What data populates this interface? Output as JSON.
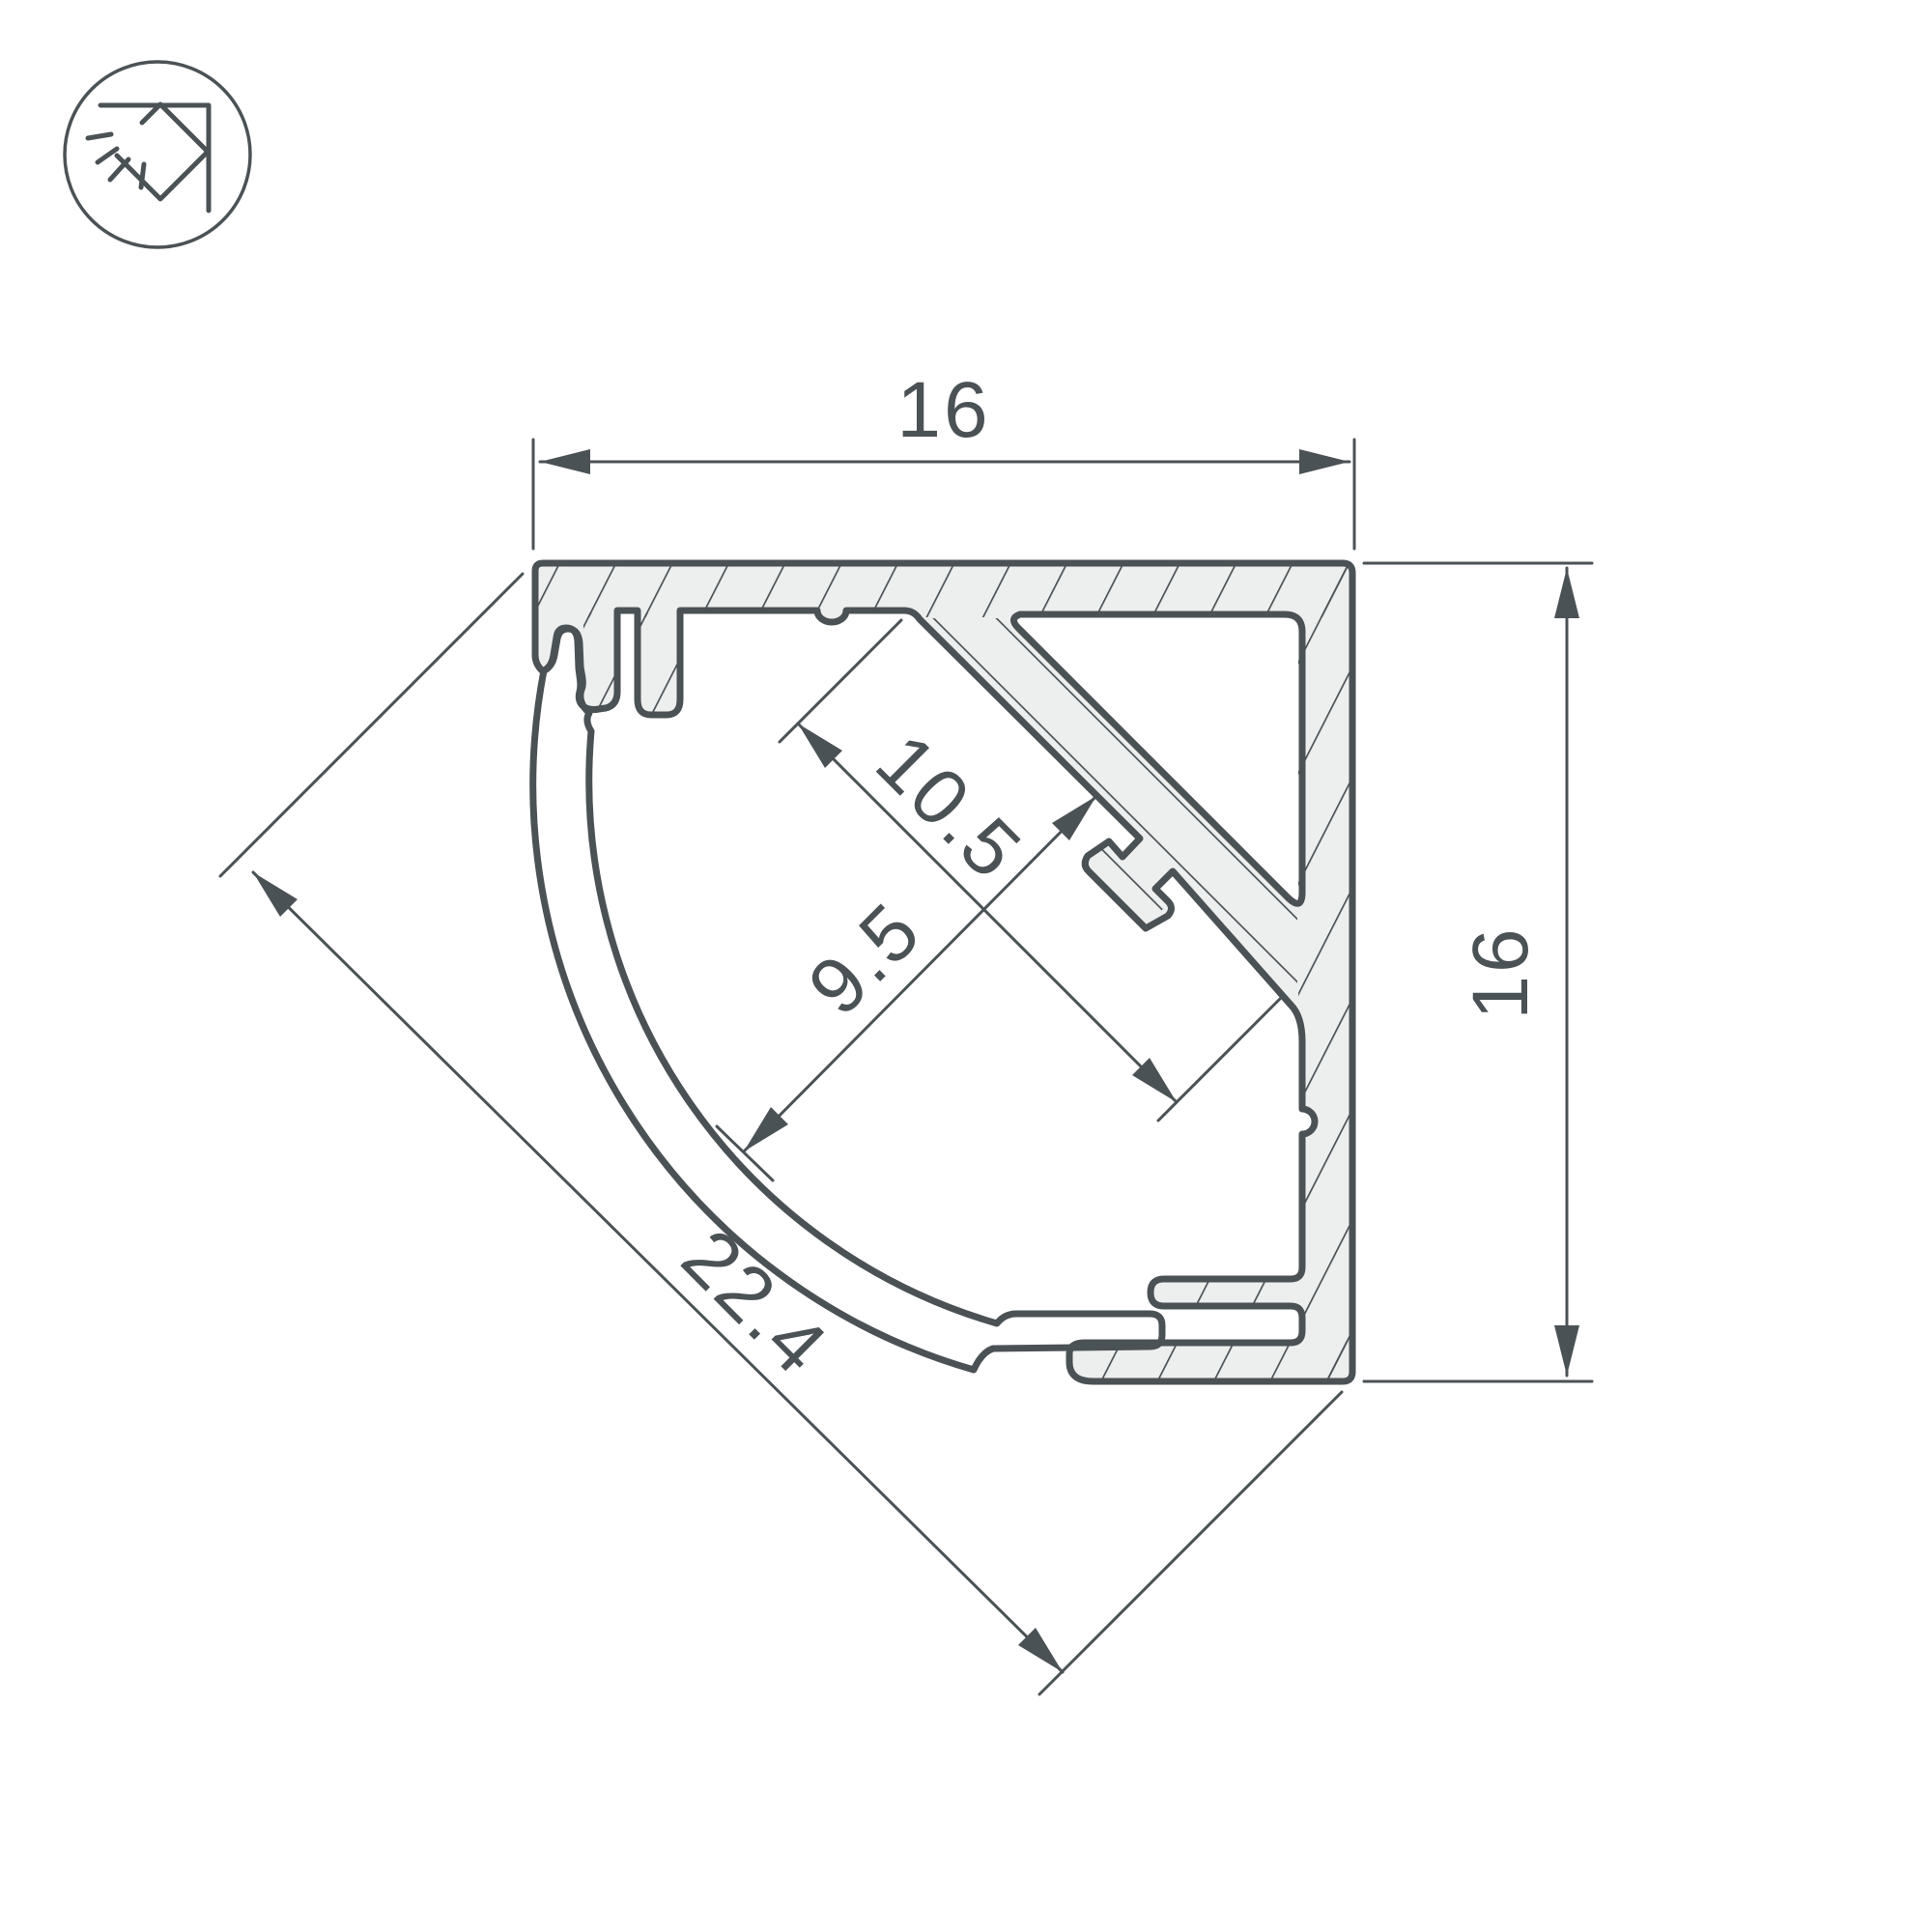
{
  "drawing": {
    "type": "technical-cross-section",
    "subject": "corner LED aluminum profile with round diffuser cover",
    "units_shown": "mm",
    "dimensions": {
      "top_width": "16",
      "right_height": "16",
      "led_shelf_width": "10.5",
      "cavity_depth": "9.5",
      "diagonal_face": "22.4"
    },
    "icon": {
      "name": "corner-mount-light-icon",
      "description": "circled pictogram of profile mounted in a wall corner emitting light rays"
    },
    "colors": {
      "line": "#4b5256",
      "aluminum_fill": "#edefee",
      "background": "#ffffff"
    }
  }
}
